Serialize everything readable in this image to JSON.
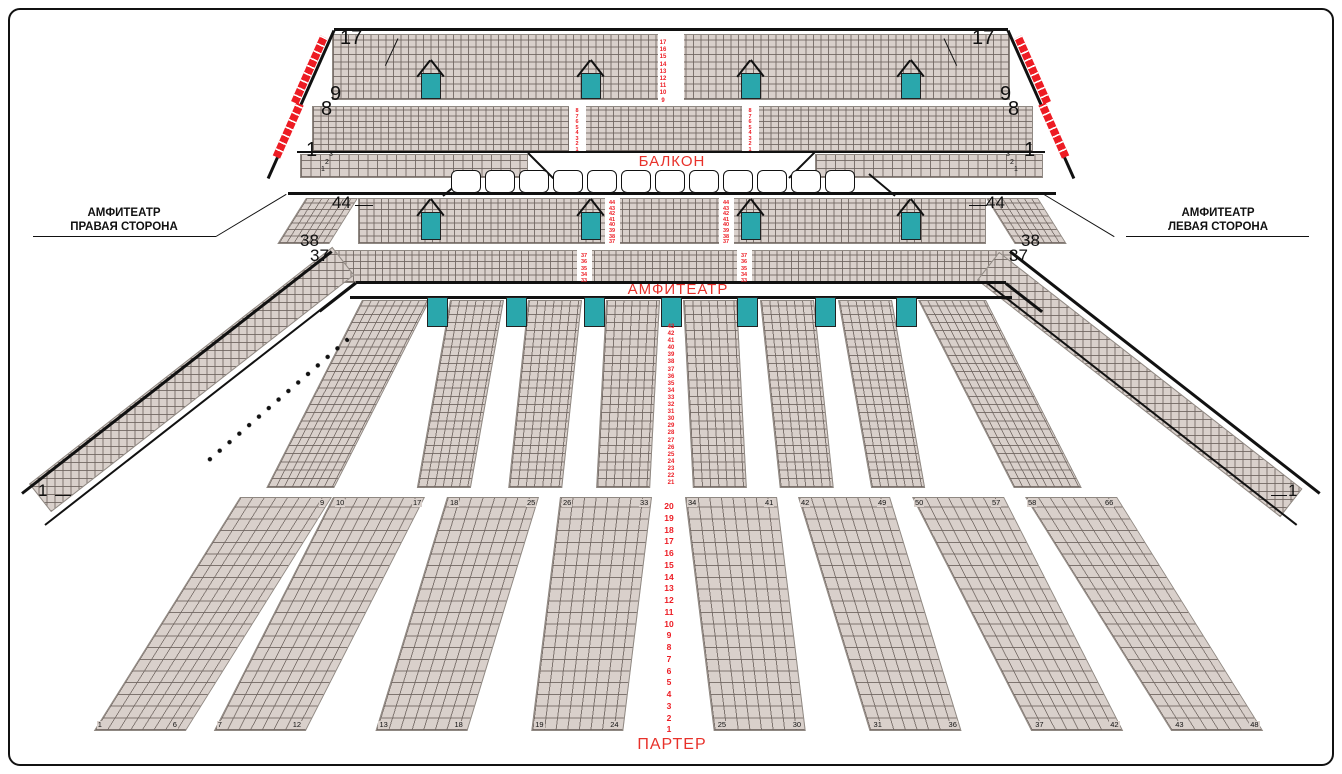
{
  "meta": {
    "width": 1342,
    "height": 774,
    "description": "Concert hall seating plan (balcony / amphitheatre / parterre)"
  },
  "colors": {
    "seat": "#d9d0cb",
    "seat_border": "#8f8882",
    "red": "#ed1c24",
    "red_text": "#e8312a",
    "teal": "#2aa7ac",
    "line": "#111"
  },
  "section_labels": {
    "balcony": "БАЛКОН",
    "amphitheatre": "АМФИТЕАТР",
    "parterre": "ПАРТЕР"
  },
  "side_callouts": {
    "right_side": {
      "line1": "АМФИТЕАТР",
      "line2": "ПРАВАЯ СТОРОНА"
    },
    "left_side": {
      "line1": "АМФИТЕАТР",
      "line2": "ЛЕВАЯ СТОРОНА"
    }
  },
  "aisle_numbers": {
    "balcony_upper": [
      "17",
      "16",
      "15",
      "14",
      "13",
      "12",
      "11",
      "10",
      "9"
    ],
    "balcony_lower": [
      "8",
      "7",
      "6",
      "5",
      "4",
      "3",
      "2",
      "1"
    ],
    "amphi_upper": [
      "44",
      "43",
      "42",
      "41",
      "40",
      "39",
      "38",
      "37"
    ],
    "amphi_mid": [
      "37",
      "36",
      "35",
      "34",
      "33"
    ],
    "amphi_bowl": [
      "43",
      "42",
      "41",
      "40",
      "39",
      "38",
      "37",
      "36",
      "35",
      "34",
      "33",
      "32",
      "31",
      "30",
      "29",
      "28",
      "27",
      "26",
      "25",
      "24",
      "23",
      "22",
      "21"
    ],
    "parterre": [
      "20",
      "19",
      "18",
      "17",
      "16",
      "15",
      "14",
      "13",
      "12",
      "11",
      "10",
      "9",
      "8",
      "7",
      "6",
      "5",
      "4",
      "3",
      "2",
      "1"
    ]
  },
  "row_markers": {
    "balcony_left": [
      "17",
      "9",
      "8",
      "1"
    ],
    "balcony_right": [
      "17",
      "9",
      "8",
      "1"
    ],
    "amphi_left": [
      "44",
      "38",
      "37"
    ],
    "amphi_right": [
      "44",
      "38",
      "37"
    ],
    "wing_left": "1",
    "wing_right": "1",
    "balcony_strip": [
      "3",
      "2",
      "1"
    ]
  },
  "parterre_blocks": [
    {
      "tl": "",
      "tr": "9",
      "bl": "1",
      "br": "6"
    },
    {
      "tl": "10",
      "tr": "17",
      "bl": "7",
      "br": "12"
    },
    {
      "tl": "18",
      "tr": "25",
      "bl": "13",
      "br": "18"
    },
    {
      "tl": "26",
      "tr": "33",
      "bl": "19",
      "br": "24"
    },
    {
      "tl": "34",
      "tr": "41",
      "bl": "25",
      "br": "30"
    },
    {
      "tl": "42",
      "tr": "49",
      "bl": "31",
      "br": "36"
    },
    {
      "tl": "50",
      "tr": "57",
      "bl": "37",
      "br": "42"
    },
    {
      "tl": "58",
      "tr": "66",
      "bl": "43",
      "br": "48"
    }
  ],
  "loges": {
    "count": 12,
    "x0": 451,
    "y": 170,
    "w": 30,
    "h": 23,
    "gap": 4
  },
  "geometry": [
    {
      "k": "seats",
      "n": "balcony-upper-seats",
      "i": true,
      "x": 332,
      "y": 34,
      "w": 678,
      "h": 66,
      "cw": 7.5,
      "ch": 7.34
    },
    {
      "k": "seats",
      "n": "balcony-lower-seats",
      "i": true,
      "x": 312,
      "y": 106,
      "w": 721,
      "h": 46,
      "cw": 7.5,
      "ch": 5.76
    },
    {
      "k": "seats",
      "n": "balcony-strip-left-seats",
      "i": true,
      "x": 300,
      "y": 154,
      "w": 228,
      "h": 24,
      "cw": 9.5,
      "ch": 8
    },
    {
      "k": "seats",
      "n": "balcony-strip-right-seats",
      "i": true,
      "x": 815,
      "y": 154,
      "w": 228,
      "h": 24,
      "cw": 9.5,
      "ch": 8
    },
    {
      "k": "seats",
      "n": "amphi-upper-seats",
      "i": true,
      "x": 358,
      "y": 198,
      "w": 628,
      "h": 46,
      "cw": 7.3,
      "ch": 6.58
    },
    {
      "k": "seats",
      "n": "amphi-upper-left-ext",
      "i": true,
      "x": 306,
      "y": 198,
      "w": 52,
      "h": 46,
      "cw": 7.3,
      "ch": 6.58,
      "skew": -32
    },
    {
      "k": "seats",
      "n": "amphi-upper-right-ext",
      "i": true,
      "x": 986,
      "y": 198,
      "w": 52,
      "h": 46,
      "cw": 7.3,
      "ch": 6.58,
      "skew": 32
    },
    {
      "k": "seats",
      "n": "amphi-mid-seats",
      "i": true,
      "x": 330,
      "y": 250,
      "w": 682,
      "h": 33,
      "cw": 7.3,
      "ch": 6.6
    },
    {
      "k": "seats",
      "n": "bowl-outer-left-seats",
      "i": true,
      "x": 362,
      "y": 300,
      "w": 68,
      "h": 188,
      "cw": 8,
      "ch": 8.2,
      "skew": -27
    },
    {
      "k": "seats",
      "n": "bowl-block-1",
      "i": true,
      "x": 450,
      "y": 300,
      "w": 54,
      "h": 188,
      "cw": 8.2,
      "ch": 8.2,
      "skew": -10
    },
    {
      "k": "seats",
      "n": "bowl-block-2",
      "i": true,
      "x": 528,
      "y": 300,
      "w": 54,
      "h": 188,
      "cw": 8.2,
      "ch": 8.2,
      "skew": -6
    },
    {
      "k": "seats",
      "n": "bowl-block-3",
      "i": true,
      "x": 606,
      "y": 300,
      "w": 54,
      "h": 188,
      "cw": 8.2,
      "ch": 8.2,
      "skew": -3
    },
    {
      "k": "seats",
      "n": "bowl-block-4",
      "i": true,
      "x": 683,
      "y": 300,
      "w": 54,
      "h": 188,
      "cw": 8.2,
      "ch": 8.2,
      "skew": 3
    },
    {
      "k": "seats",
      "n": "bowl-block-5",
      "i": true,
      "x": 760,
      "y": 300,
      "w": 54,
      "h": 188,
      "cw": 8.2,
      "ch": 8.2,
      "skew": 6
    },
    {
      "k": "seats",
      "n": "bowl-block-6",
      "i": true,
      "x": 838,
      "y": 300,
      "w": 54,
      "h": 188,
      "cw": 8.2,
      "ch": 8.2,
      "skew": 10
    },
    {
      "k": "seats",
      "n": "bowl-outer-right-seats",
      "i": true,
      "x": 918,
      "y": 300,
      "w": 68,
      "h": 188,
      "cw": 8,
      "ch": 8.2,
      "skew": 27
    },
    {
      "k": "seats",
      "n": "wing-left-seats",
      "i": true,
      "x": 40,
      "y": 498,
      "w": 385,
      "h": 36,
      "cw": 8,
      "ch": 8,
      "rot": -38
    },
    {
      "k": "seats",
      "n": "wing-right-seats",
      "i": true,
      "x": 988,
      "y": 266,
      "w": 385,
      "h": 36,
      "cw": 8,
      "ch": 8,
      "rot": 38
    },
    {
      "k": "pblock",
      "n": "parterre-block-1",
      "i": true,
      "x": 240,
      "y": 497,
      "w": 92,
      "h": 234,
      "cw": 11.6,
      "ch": 11.7,
      "skew": -32,
      "idx": 0
    },
    {
      "k": "pblock",
      "n": "parterre-block-2",
      "i": true,
      "x": 333,
      "y": 497,
      "w": 92,
      "h": 234,
      "cw": 11.6,
      "ch": 11.7,
      "skew": -27,
      "idx": 1
    },
    {
      "k": "pblock",
      "n": "parterre-block-3",
      "i": true,
      "x": 447,
      "y": 497,
      "w": 92,
      "h": 234,
      "cw": 11.6,
      "ch": 11.7,
      "skew": -17,
      "idx": 2
    },
    {
      "k": "pblock",
      "n": "parterre-block-4",
      "i": true,
      "x": 560,
      "y": 497,
      "w": 92,
      "h": 234,
      "cw": 11.6,
      "ch": 11.7,
      "skew": -7,
      "idx": 3
    },
    {
      "k": "pblock",
      "n": "parterre-block-5",
      "i": true,
      "x": 685,
      "y": 497,
      "w": 92,
      "h": 234,
      "cw": 11.6,
      "ch": 11.7,
      "skew": 7,
      "idx": 4
    },
    {
      "k": "pblock",
      "n": "parterre-block-6",
      "i": true,
      "x": 798,
      "y": 497,
      "w": 92,
      "h": 234,
      "cw": 11.6,
      "ch": 11.7,
      "skew": 17,
      "idx": 5
    },
    {
      "k": "pblock",
      "n": "parterre-block-7",
      "i": true,
      "x": 912,
      "y": 497,
      "w": 92,
      "h": 234,
      "cw": 11.6,
      "ch": 11.7,
      "skew": 27,
      "idx": 6
    },
    {
      "k": "pblock",
      "n": "parterre-block-8",
      "i": true,
      "x": 1025,
      "y": 497,
      "w": 92,
      "h": 234,
      "cw": 11.6,
      "ch": 11.7,
      "skew": 32,
      "idx": 7
    },
    {
      "k": "gap",
      "x": 658,
      "y": 34,
      "w": 26,
      "h": 66
    },
    {
      "k": "gap",
      "x": 569,
      "y": 106,
      "w": 17,
      "h": 46
    },
    {
      "k": "gap",
      "x": 742,
      "y": 106,
      "w": 17,
      "h": 46
    },
    {
      "k": "gap",
      "x": 605,
      "y": 198,
      "w": 15,
      "h": 46
    },
    {
      "k": "gap",
      "x": 719,
      "y": 198,
      "w": 15,
      "h": 46
    },
    {
      "k": "gap",
      "x": 577,
      "y": 250,
      "w": 15,
      "h": 33
    },
    {
      "k": "gap",
      "x": 737,
      "y": 250,
      "w": 15,
      "h": 33
    },
    {
      "k": "line",
      "n": "balcony-top-edge",
      "x": 334,
      "y": 28,
      "w": 674,
      "th": 3
    },
    {
      "k": "line",
      "n": "balcony-left-slant",
      "x": 334,
      "y": 29,
      "w": 162,
      "th": 3,
      "rot": 114
    },
    {
      "k": "line",
      "n": "balcony-right-slant",
      "x": 1008,
      "y": 29,
      "w": 162,
      "th": 3,
      "rot": 66
    },
    {
      "k": "line",
      "n": "balcony-tier-divider",
      "x": 297,
      "y": 151,
      "w": 748,
      "th": 1.5
    },
    {
      "k": "line",
      "n": "balcony-bottom-edge",
      "x": 288,
      "y": 192,
      "w": 768,
      "th": 3
    },
    {
      "k": "line",
      "n": "amphi-band-top",
      "x": 356,
      "y": 281,
      "w": 650,
      "th": 2.5
    },
    {
      "k": "line",
      "n": "amphi-band-bottom",
      "x": 350,
      "y": 296,
      "w": 662,
      "th": 2.5
    },
    {
      "k": "line",
      "n": "amphi-band-diag-left",
      "x": 356,
      "y": 282,
      "w": 46,
      "th": 2.5,
      "rot": 142
    },
    {
      "k": "line",
      "n": "amphi-band-diag-right",
      "x": 1006,
      "y": 282,
      "w": 46,
      "th": 2.5,
      "rot": 38
    },
    {
      "k": "line",
      "n": "wing-left-outer-edge",
      "x": 22,
      "y": 492,
      "w": 393,
      "th": 3,
      "rot": -38
    },
    {
      "k": "line",
      "n": "wing-left-inner-edge",
      "x": 45,
      "y": 524,
      "w": 393,
      "th": 2,
      "rot": -38
    },
    {
      "k": "line",
      "n": "wing-right-outer-edge",
      "x": 1010,
      "y": 250,
      "w": 393,
      "th": 3,
      "rot": 38
    },
    {
      "k": "line",
      "n": "wing-right-inner-edge",
      "x": 987,
      "y": 282,
      "w": 393,
      "th": 2,
      "rot": 38
    },
    {
      "k": "line",
      "n": "loge-slant-left",
      "x": 443,
      "y": 195,
      "w": 34,
      "th": 2,
      "rot": -40
    },
    {
      "k": "line",
      "n": "loge-slant-right",
      "x": 869,
      "y": 173,
      "w": 34,
      "th": 2,
      "rot": 40
    },
    {
      "k": "line",
      "n": "strip-slant-left",
      "x": 528,
      "y": 152,
      "w": 36,
      "th": 2,
      "rot": 45
    },
    {
      "k": "line",
      "n": "strip-slant-right",
      "x": 789,
      "y": 177,
      "w": 36,
      "th": 2,
      "rot": -45
    },
    {
      "k": "line",
      "n": "callout-left-underline",
      "x": 33,
      "y": 236,
      "w": 183,
      "th": 1
    },
    {
      "k": "line",
      "n": "callout-left-leader",
      "x": 216,
      "y": 236,
      "w": 82,
      "th": 1,
      "rot": -31
    },
    {
      "k": "line",
      "n": "callout-right-underline",
      "x": 1126,
      "y": 236,
      "w": 183,
      "th": 1
    },
    {
      "k": "line",
      "n": "callout-right-leader",
      "x": 1044,
      "y": 194,
      "w": 82,
      "th": 1,
      "rot": 31
    },
    {
      "k": "line",
      "n": "tick-44-left",
      "x": 355,
      "y": 205,
      "w": 18,
      "th": 1
    },
    {
      "k": "line",
      "n": "tick-44-right",
      "x": 969,
      "y": 205,
      "w": 18,
      "th": 1
    },
    {
      "k": "line",
      "n": "tick-17-left",
      "x": 398,
      "y": 38,
      "w": 30,
      "th": 1,
      "rot": 115
    },
    {
      "k": "line",
      "n": "tick-17-right",
      "x": 944,
      "y": 38,
      "w": 30,
      "th": 1,
      "rot": 65
    },
    {
      "k": "line",
      "n": "tick-1-wing-left",
      "x": 55,
      "y": 495,
      "w": 16,
      "th": 1
    },
    {
      "k": "line",
      "n": "tick-1-wing-right",
      "x": 1271,
      "y": 495,
      "w": 16,
      "th": 1
    },
    {
      "k": "door",
      "n": "balcony-door",
      "x": 421,
      "y": 73,
      "w": 20,
      "h": 26
    },
    {
      "k": "door",
      "n": "balcony-door",
      "x": 581,
      "y": 73,
      "w": 20,
      "h": 26
    },
    {
      "k": "door",
      "n": "balcony-door",
      "x": 741,
      "y": 73,
      "w": 20,
      "h": 26
    },
    {
      "k": "door",
      "n": "balcony-door",
      "x": 901,
      "y": 73,
      "w": 20,
      "h": 26
    },
    {
      "k": "funnel",
      "x": 431,
      "y": 73
    },
    {
      "k": "funnel",
      "x": 591,
      "y": 73
    },
    {
      "k": "funnel",
      "x": 751,
      "y": 73
    },
    {
      "k": "funnel",
      "x": 911,
      "y": 73
    },
    {
      "k": "door",
      "n": "amphi-upper-door",
      "x": 421,
      "y": 212,
      "w": 20,
      "h": 28
    },
    {
      "k": "door",
      "n": "amphi-upper-door",
      "x": 581,
      "y": 212,
      "w": 20,
      "h": 28
    },
    {
      "k": "door",
      "n": "amphi-upper-door",
      "x": 741,
      "y": 212,
      "w": 20,
      "h": 28
    },
    {
      "k": "door",
      "n": "amphi-upper-door",
      "x": 901,
      "y": 212,
      "w": 20,
      "h": 28
    },
    {
      "k": "funnel",
      "x": 431,
      "y": 212
    },
    {
      "k": "funnel",
      "x": 591,
      "y": 212
    },
    {
      "k": "funnel",
      "x": 751,
      "y": 212
    },
    {
      "k": "funnel",
      "x": 911,
      "y": 212
    },
    {
      "k": "door",
      "n": "bowl-door",
      "x": 427,
      "y": 297,
      "w": 21,
      "h": 30
    },
    {
      "k": "door",
      "n": "bowl-door",
      "x": 506,
      "y": 297,
      "w": 21,
      "h": 30
    },
    {
      "k": "door",
      "n": "bowl-door",
      "x": 584,
      "y": 297,
      "w": 21,
      "h": 30
    },
    {
      "k": "door",
      "n": "bowl-door",
      "x": 661,
      "y": 297,
      "w": 21,
      "h": 30
    },
    {
      "k": "door",
      "n": "bowl-door",
      "x": 737,
      "y": 297,
      "w": 21,
      "h": 30
    },
    {
      "k": "door",
      "n": "bowl-door",
      "x": 815,
      "y": 297,
      "w": 21,
      "h": 30
    },
    {
      "k": "door",
      "n": "bowl-door",
      "x": 896,
      "y": 297,
      "w": 21,
      "h": 30
    },
    {
      "k": "red",
      "n": "balcony-red-seats-left-upper",
      "i": true,
      "x": 320,
      "y": 37,
      "h": 72,
      "rot": 24
    },
    {
      "k": "red",
      "n": "balcony-red-seats-left-lower",
      "i": true,
      "x": 296,
      "y": 104,
      "h": 58,
      "rot": 24
    },
    {
      "k": "red",
      "n": "balcony-red-seats-right-upper",
      "i": true,
      "x": 1014,
      "y": 37,
      "h": 72,
      "rot": -24
    },
    {
      "k": "red",
      "n": "balcony-red-seats-right-lower",
      "i": true,
      "x": 1038,
      "y": 104,
      "h": 58,
      "rot": -24
    },
    {
      "k": "col",
      "n": "balcony-upper-row-numbers",
      "x": 663,
      "y": 40,
      "step": 7.2,
      "s": 6,
      "ref": "balcony_upper"
    },
    {
      "k": "col",
      "n": "balcony-lower-row-numbers",
      "x": 577,
      "y": 109,
      "step": 5.5,
      "s": 5.5,
      "ref": "balcony_lower"
    },
    {
      "k": "col",
      "n": "balcony-lower-row-numbers",
      "x": 750,
      "y": 109,
      "step": 5.5,
      "s": 5.5,
      "ref": "balcony_lower"
    },
    {
      "k": "col",
      "n": "amphi-upper-row-numbers",
      "x": 612,
      "y": 201,
      "step": 5.6,
      "s": 5.5,
      "ref": "amphi_upper"
    },
    {
      "k": "col",
      "n": "amphi-upper-row-numbers",
      "x": 726,
      "y": 201,
      "step": 5.6,
      "s": 5.5,
      "ref": "amphi_upper"
    },
    {
      "k": "col",
      "n": "amphi-mid-row-numbers",
      "x": 584,
      "y": 253,
      "step": 6.3,
      "s": 5.5,
      "ref": "amphi_mid"
    },
    {
      "k": "col",
      "n": "amphi-mid-row-numbers",
      "x": 744,
      "y": 253,
      "step": 6.3,
      "s": 5.5,
      "ref": "amphi_mid"
    },
    {
      "k": "col",
      "n": "amphi-bowl-row-numbers",
      "x": 671,
      "y": 324,
      "step": 7.1,
      "s": 6,
      "ref": "amphi_bowl"
    },
    {
      "k": "col",
      "n": "parterre-row-numbers",
      "x": 669,
      "y": 501,
      "step": 11.75,
      "s": 8.5,
      "ref": "parterre"
    },
    {
      "k": "dots",
      "n": "wing-left-dotted-line",
      "x": 205,
      "y": 461,
      "w": 190,
      "rot": -41
    },
    {
      "k": "txt",
      "n": "row-marker-17-left",
      "t": "17",
      "x": 340,
      "y": 28,
      "s": 20
    },
    {
      "k": "txt",
      "n": "row-marker-9-left",
      "t": "9",
      "x": 330,
      "y": 84,
      "s": 20
    },
    {
      "k": "txt",
      "n": "row-marker-8-left",
      "t": "8",
      "x": 321,
      "y": 99,
      "s": 20
    },
    {
      "k": "txt",
      "n": "row-marker-1-left",
      "t": "1",
      "x": 306,
      "y": 140,
      "s": 20
    },
    {
      "k": "txt",
      "n": "row-marker-17-right",
      "t": "17",
      "x": 972,
      "y": 28,
      "s": 20
    },
    {
      "k": "txt",
      "n": "row-marker-9-right",
      "t": "9",
      "x": 1000,
      "y": 84,
      "s": 20
    },
    {
      "k": "txt",
      "n": "row-marker-8-right",
      "t": "8",
      "x": 1008,
      "y": 99,
      "s": 20
    },
    {
      "k": "txt",
      "n": "row-marker-1-right",
      "t": "1",
      "x": 1024,
      "y": 140,
      "s": 20
    },
    {
      "k": "txt",
      "n": "row-marker-44-left",
      "t": "44",
      "x": 332,
      "y": 194,
      "s": 17
    },
    {
      "k": "txt",
      "n": "row-marker-38-left",
      "t": "38",
      "x": 300,
      "y": 232,
      "s": 17
    },
    {
      "k": "txt",
      "n": "row-marker-37-left",
      "t": "37",
      "x": 310,
      "y": 247,
      "s": 17
    },
    {
      "k": "txt",
      "n": "row-marker-44-right",
      "t": "44",
      "x": 986,
      "y": 194,
      "s": 17
    },
    {
      "k": "txt",
      "n": "row-marker-38-right",
      "t": "38",
      "x": 1021,
      "y": 232,
      "s": 17
    },
    {
      "k": "txt",
      "n": "row-marker-37-right",
      "t": "37",
      "x": 1009,
      "y": 247,
      "s": 17
    },
    {
      "k": "txt",
      "n": "row-marker-1-wing-left",
      "t": "1",
      "x": 38,
      "y": 482,
      "s": 17
    },
    {
      "k": "txt",
      "n": "row-marker-1-wing-right",
      "t": "1",
      "x": 1288,
      "y": 482,
      "s": 17
    },
    {
      "k": "txt",
      "n": "strip-row-3-left",
      "t": "3",
      "x": 329,
      "y": 151,
      "s": 7
    },
    {
      "k": "txt",
      "n": "strip-row-2-left",
      "t": "2",
      "x": 325,
      "y": 158.5,
      "s": 7
    },
    {
      "k": "txt",
      "n": "strip-row-1-left",
      "t": "1",
      "x": 321,
      "y": 166,
      "s": 7
    },
    {
      "k": "txt",
      "n": "strip-row-3-right",
      "t": "3",
      "x": 1006,
      "y": 151,
      "s": 7
    },
    {
      "k": "txt",
      "n": "strip-row-2-right",
      "t": "2",
      "x": 1010,
      "y": 158.5,
      "s": 7
    },
    {
      "k": "txt",
      "n": "strip-row-1-right",
      "t": "1",
      "x": 1014,
      "y": 166,
      "s": 7
    }
  ]
}
